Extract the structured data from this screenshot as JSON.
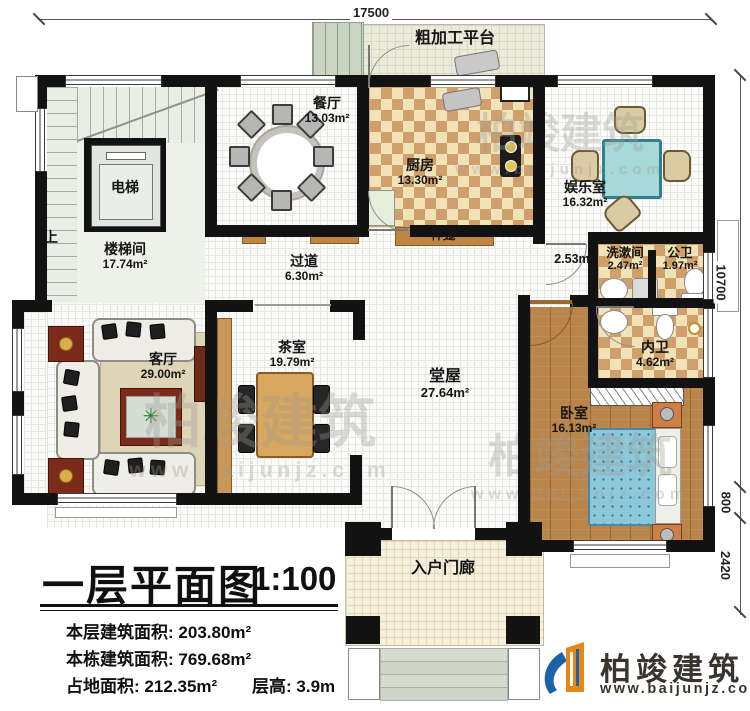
{
  "dim": {
    "top": "17500",
    "right": [
      "10700",
      "800",
      "2420"
    ]
  },
  "rooms": [
    {
      "label": "粗加工平台"
    },
    {
      "label": "餐厅",
      "area": "13.03m²"
    },
    {
      "label": "厨房",
      "area": "13.30m²"
    },
    {
      "label": "娱乐室",
      "area": "16.32m²"
    },
    {
      "label": "电梯"
    },
    {
      "label": "楼梯间",
      "area": "17.74m²"
    },
    {
      "label": "上"
    },
    {
      "label": "过道",
      "area": "6.30m²"
    },
    {
      "label": "神龛"
    },
    {
      "area": "2.53m²"
    },
    {
      "label": "洗漱间",
      "area": "2.47m²"
    },
    {
      "label": "公卫",
      "area": "1.97m²"
    },
    {
      "label": "内卫",
      "area": "4.62m²"
    },
    {
      "label": "客厅",
      "area": "29.00m²"
    },
    {
      "label": "茶室",
      "area": "19.79m²"
    },
    {
      "label": "堂屋",
      "area": "27.64m²"
    },
    {
      "label": "卧室",
      "area": "16.13m²"
    },
    {
      "label": "入户门廊"
    }
  ],
  "title_block": {
    "title": "一层平面图",
    "scale": "1:100",
    "stats": [
      {
        "label": "本层建筑面积:",
        "value": "203.80m²"
      },
      {
        "label": "本栋建筑面积:",
        "value": "769.68m²"
      },
      {
        "label": "占地面积:",
        "value": "212.35m²"
      },
      {
        "label": "层高:",
        "value": "3.9m"
      }
    ]
  },
  "brand": {
    "name": "柏竣建筑",
    "website": "www.baijunjz.com"
  },
  "watermark": {
    "text": "柏竣建筑",
    "subtext": "www.baijunjz.com"
  },
  "icons": {
    "plant": "✳"
  },
  "colors": {
    "wall": "#121212",
    "checker_dark": "#cfa06b",
    "checker_light": "#f2e2b8",
    "wood": "#b9854b",
    "bed": "#8cc8da",
    "brand_blue": "#1a63a8",
    "brand_orange": "#e8861a"
  }
}
